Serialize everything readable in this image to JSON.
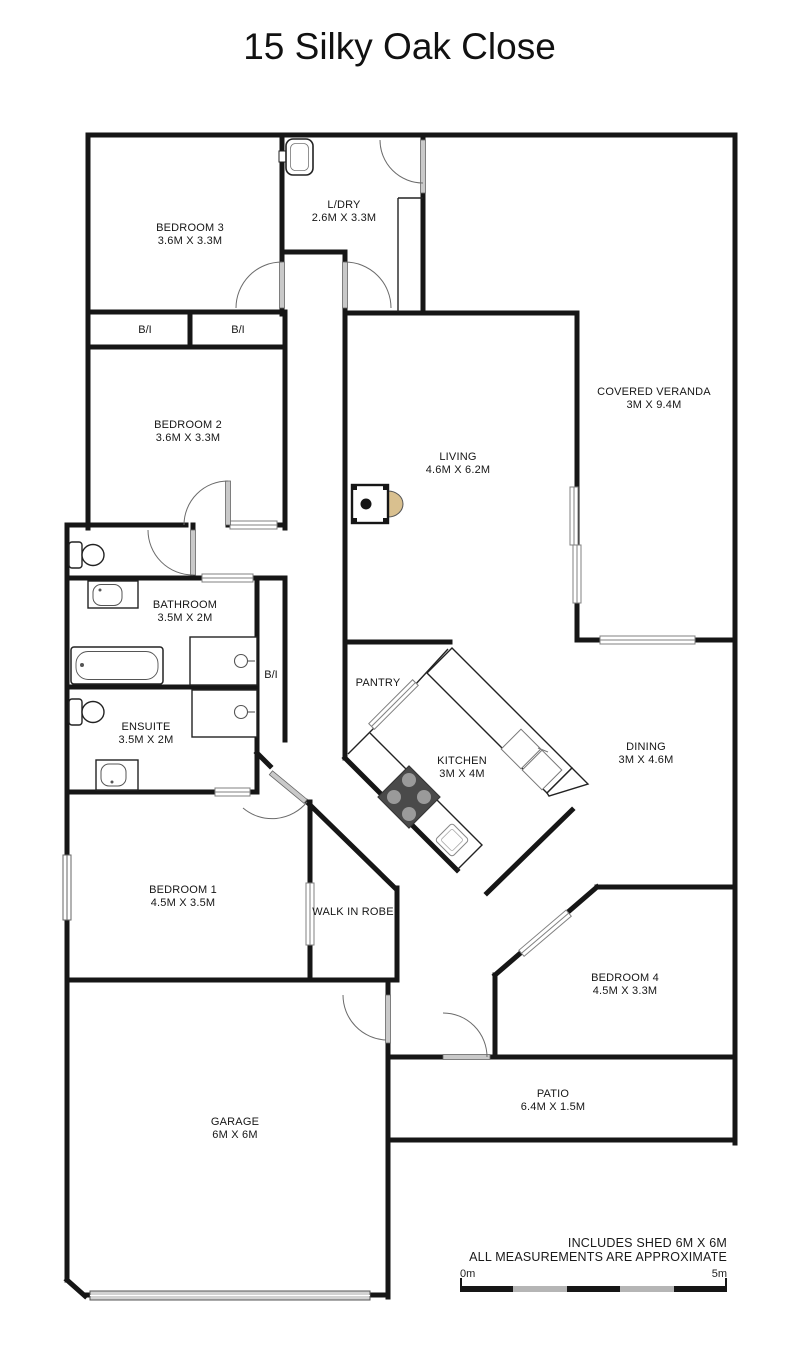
{
  "title": "15 Silky Oak Close",
  "rooms": [
    {
      "name": "BEDROOM 3",
      "dims": "3.6M X 3.3M"
    },
    {
      "name": "L/DRY",
      "dims": "2.6M X 3.3M"
    },
    {
      "name": "COVERED VERANDA",
      "dims": "3M X 9.4M"
    },
    {
      "name": "BEDROOM 2",
      "dims": "3.6M X 3.3M"
    },
    {
      "name": "LIVING",
      "dims": "4.6M X 6.2M"
    },
    {
      "name": "BATHROOM",
      "dims": "3.5M X 2M"
    },
    {
      "name": "ENSUITE",
      "dims": "3.5M X 2M"
    },
    {
      "name": "PANTRY",
      "dims": ""
    },
    {
      "name": "KITCHEN",
      "dims": "3M X 4M"
    },
    {
      "name": "DINING",
      "dims": "3M X 4.6M"
    },
    {
      "name": "BEDROOM 1",
      "dims": "4.5M X 3.5M"
    },
    {
      "name": "WALK IN ROBE",
      "dims": ""
    },
    {
      "name": "BEDROOM 4",
      "dims": "4.5M X 3.3M"
    },
    {
      "name": "PATIO",
      "dims": "6.4M X 1.5M"
    },
    {
      "name": "GARAGE",
      "dims": "6M X 6M"
    }
  ],
  "wardrobes": {
    "left": "B/I",
    "right": "B/I",
    "bath": "B/I"
  },
  "fixtures": [
    "laundry-tub",
    "wood-heater",
    "toilet",
    "vanity-basin",
    "bathtub",
    "shower",
    "cooktop",
    "kitchen-sink",
    "island-double-sink",
    "garage-door"
  ],
  "notes": {
    "line1": "INCLUDES SHED 6M X 6M",
    "line2": "ALL MEASUREMENTS ARE APPROXIMATE"
  },
  "scale_bar": {
    "start_label": "0m",
    "end_label": "5m"
  },
  "colors": {
    "wall": "#161616",
    "door_leaf": "#c9c9c9",
    "slider": "#cccccc",
    "arc": "#6b6b6b",
    "cooktop": "#4a4a4a",
    "burner": "#9a9a9a",
    "heater_fan": "#d9c08f"
  }
}
